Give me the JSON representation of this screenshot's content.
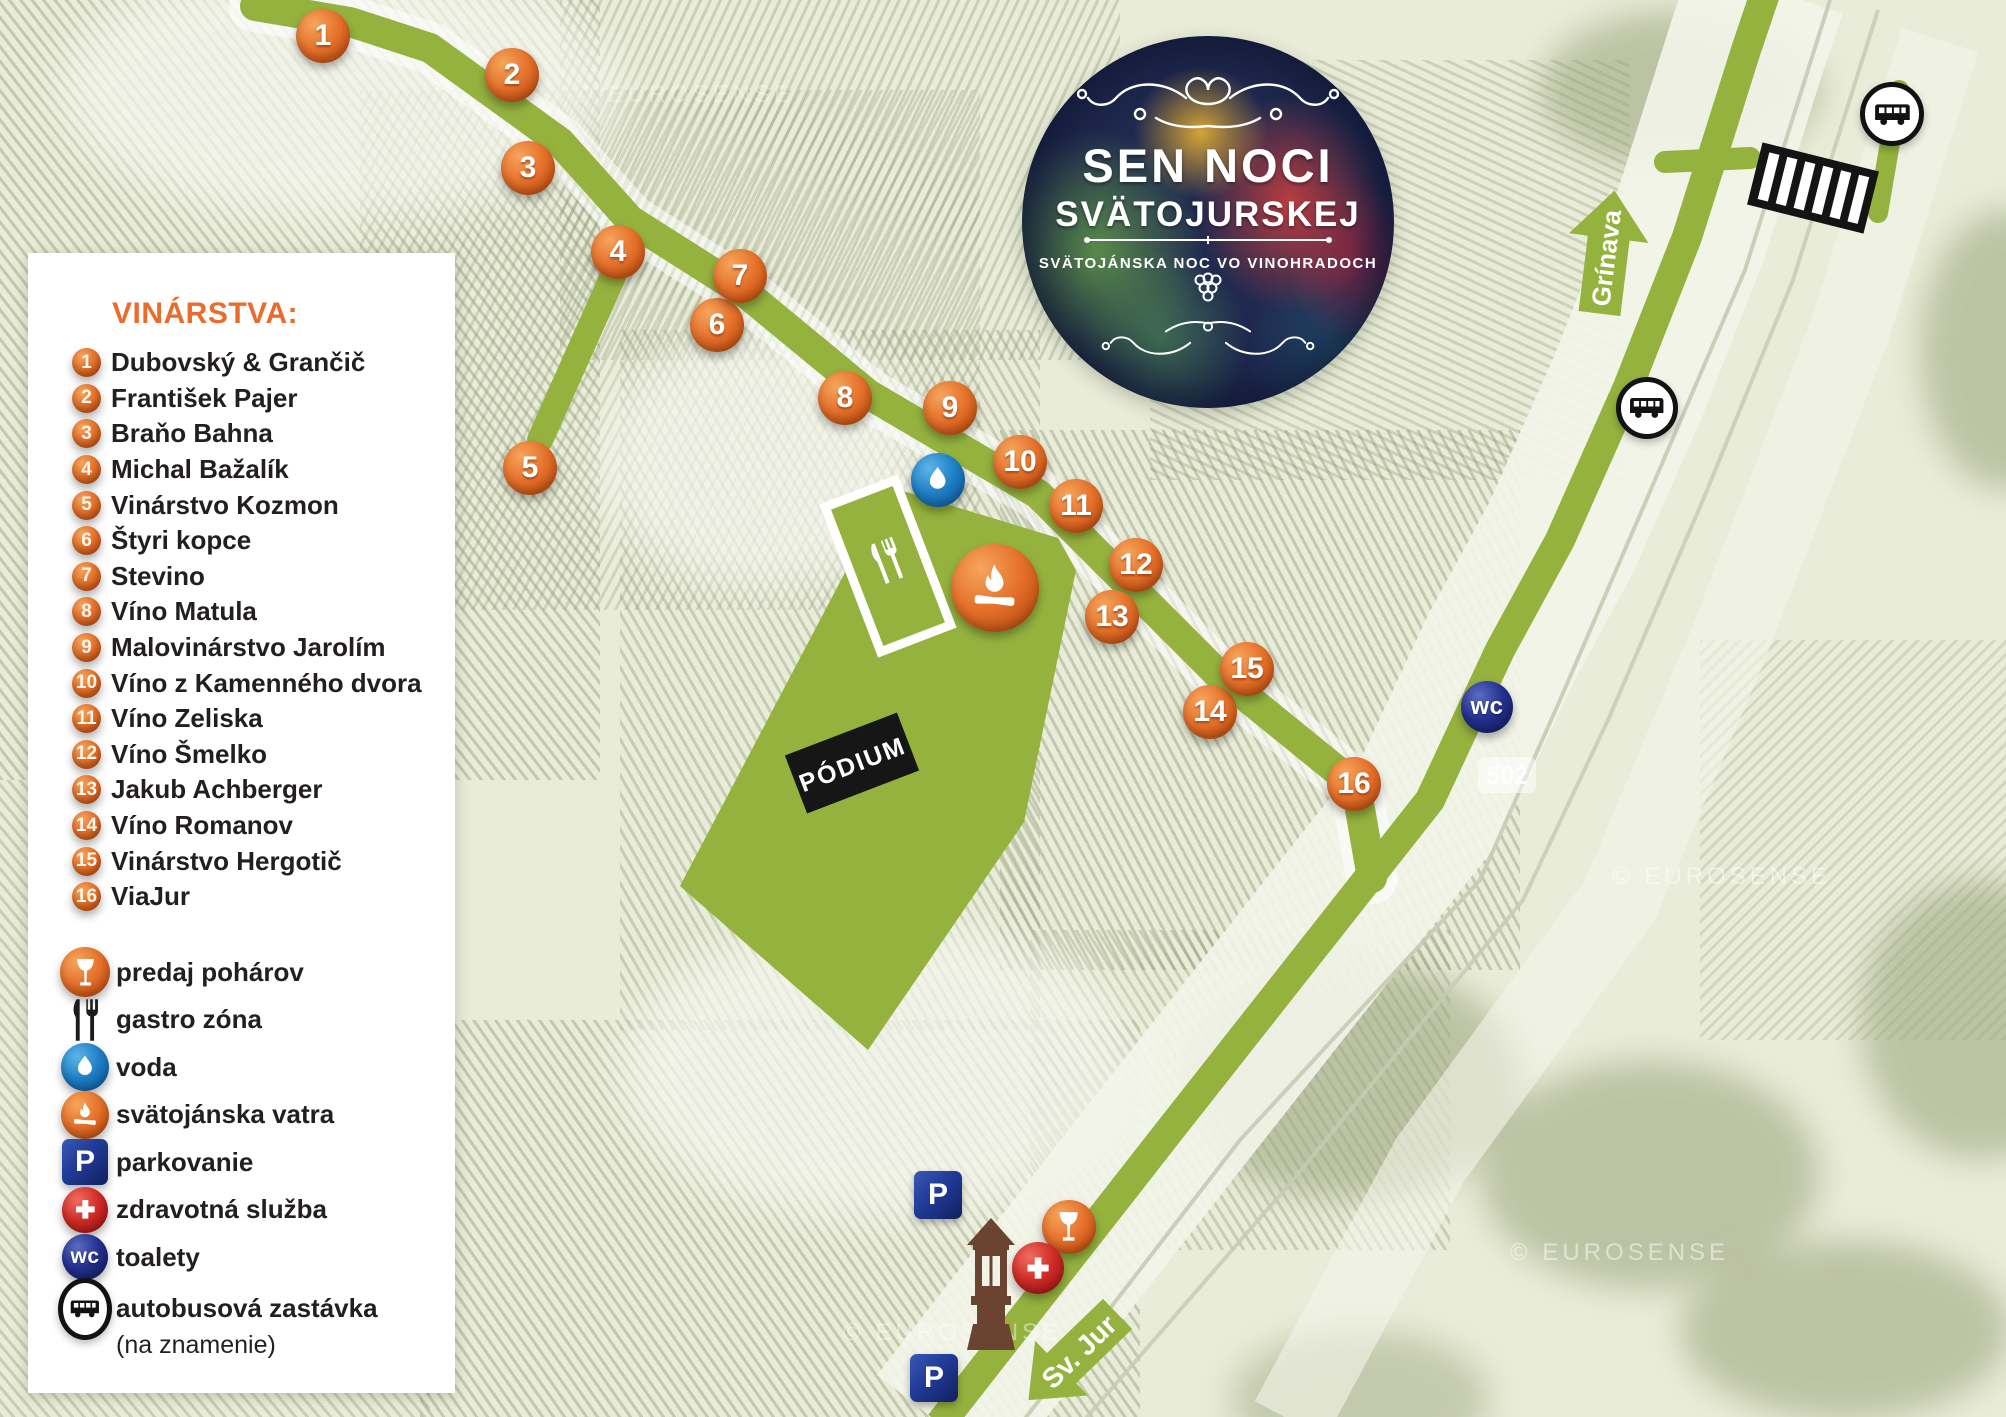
{
  "legend": {
    "title": "VINÁRSTVA:",
    "wineries": [
      {
        "n": "1",
        "name": "Dubovský & Grančič"
      },
      {
        "n": "2",
        "name": "František Pajer"
      },
      {
        "n": "3",
        "name": "Braňo Bahna"
      },
      {
        "n": "4",
        "name": "Michal Bažalík"
      },
      {
        "n": "5",
        "name": "Vinárstvo Kozmon"
      },
      {
        "n": "6",
        "name": "Štyri kopce"
      },
      {
        "n": "7",
        "name": "Stevino"
      },
      {
        "n": "8",
        "name": "Víno Matula"
      },
      {
        "n": "9",
        "name": "Malovinárstvo Jarolím"
      },
      {
        "n": "10",
        "name": "Víno z Kamenného dvora"
      },
      {
        "n": "11",
        "name": "Víno Zeliska"
      },
      {
        "n": "12",
        "name": "Víno Šmelko"
      },
      {
        "n": "13",
        "name": "Jakub Achberger"
      },
      {
        "n": "14",
        "name": "Víno Romanov"
      },
      {
        "n": "15",
        "name": "Vinárstvo Hergotič"
      },
      {
        "n": "16",
        "name": "ViaJur"
      }
    ],
    "services": [
      {
        "icon": "wine-glass",
        "label": "predaj pohárov"
      },
      {
        "icon": "cutlery",
        "label": "gastro zóna"
      },
      {
        "icon": "water-drop",
        "label": "voda"
      },
      {
        "icon": "bonfire",
        "label": "svätojánska vatra"
      },
      {
        "icon": "parking",
        "label": "parkovanie"
      },
      {
        "icon": "medical-cross",
        "label": "zdravotná služba"
      },
      {
        "icon": "wc",
        "label": "toalety"
      },
      {
        "icon": "bus",
        "label": "autobusová zastávka",
        "sublabel": "(na znamenie)"
      }
    ]
  },
  "logo": {
    "line1": "SEN NOCI",
    "line2": "SVÄTOJURSKEJ",
    "subtitle": "SVÄTOJÁNSKA NOC VO VINOHRADOCH"
  },
  "map": {
    "markers": [
      {
        "n": "1",
        "x": 323,
        "y": 36
      },
      {
        "n": "2",
        "x": 512,
        "y": 75
      },
      {
        "n": "3",
        "x": 528,
        "y": 168
      },
      {
        "n": "4",
        "x": 618,
        "y": 252
      },
      {
        "n": "5",
        "x": 530,
        "y": 468
      },
      {
        "n": "6",
        "x": 717,
        "y": 325
      },
      {
        "n": "7",
        "x": 740,
        "y": 276
      },
      {
        "n": "8",
        "x": 845,
        "y": 398
      },
      {
        "n": "9",
        "x": 950,
        "y": 408
      },
      {
        "n": "10",
        "x": 1020,
        "y": 462
      },
      {
        "n": "11",
        "x": 1076,
        "y": 506
      },
      {
        "n": "12",
        "x": 1136,
        "y": 565
      },
      {
        "n": "13",
        "x": 1112,
        "y": 617
      },
      {
        "n": "14",
        "x": 1210,
        "y": 712
      },
      {
        "n": "15",
        "x": 1247,
        "y": 669
      },
      {
        "n": "16",
        "x": 1354,
        "y": 784
      }
    ],
    "podium": "PÓDIUM",
    "road_number": "502",
    "wc": "wc",
    "parking": "P",
    "arrow_north": "Grínava",
    "arrow_south": "Sv. Jur",
    "watermark": "© EUROSENSE"
  },
  "colors": {
    "route_green": "#95b23e",
    "marker_orange": "#e4702a",
    "water_blue": "#1f7fc4",
    "navy": "#24308f",
    "red": "#cf2b26",
    "tower_brown": "#6b4431",
    "legend_title_orange": "#e96b2d"
  }
}
